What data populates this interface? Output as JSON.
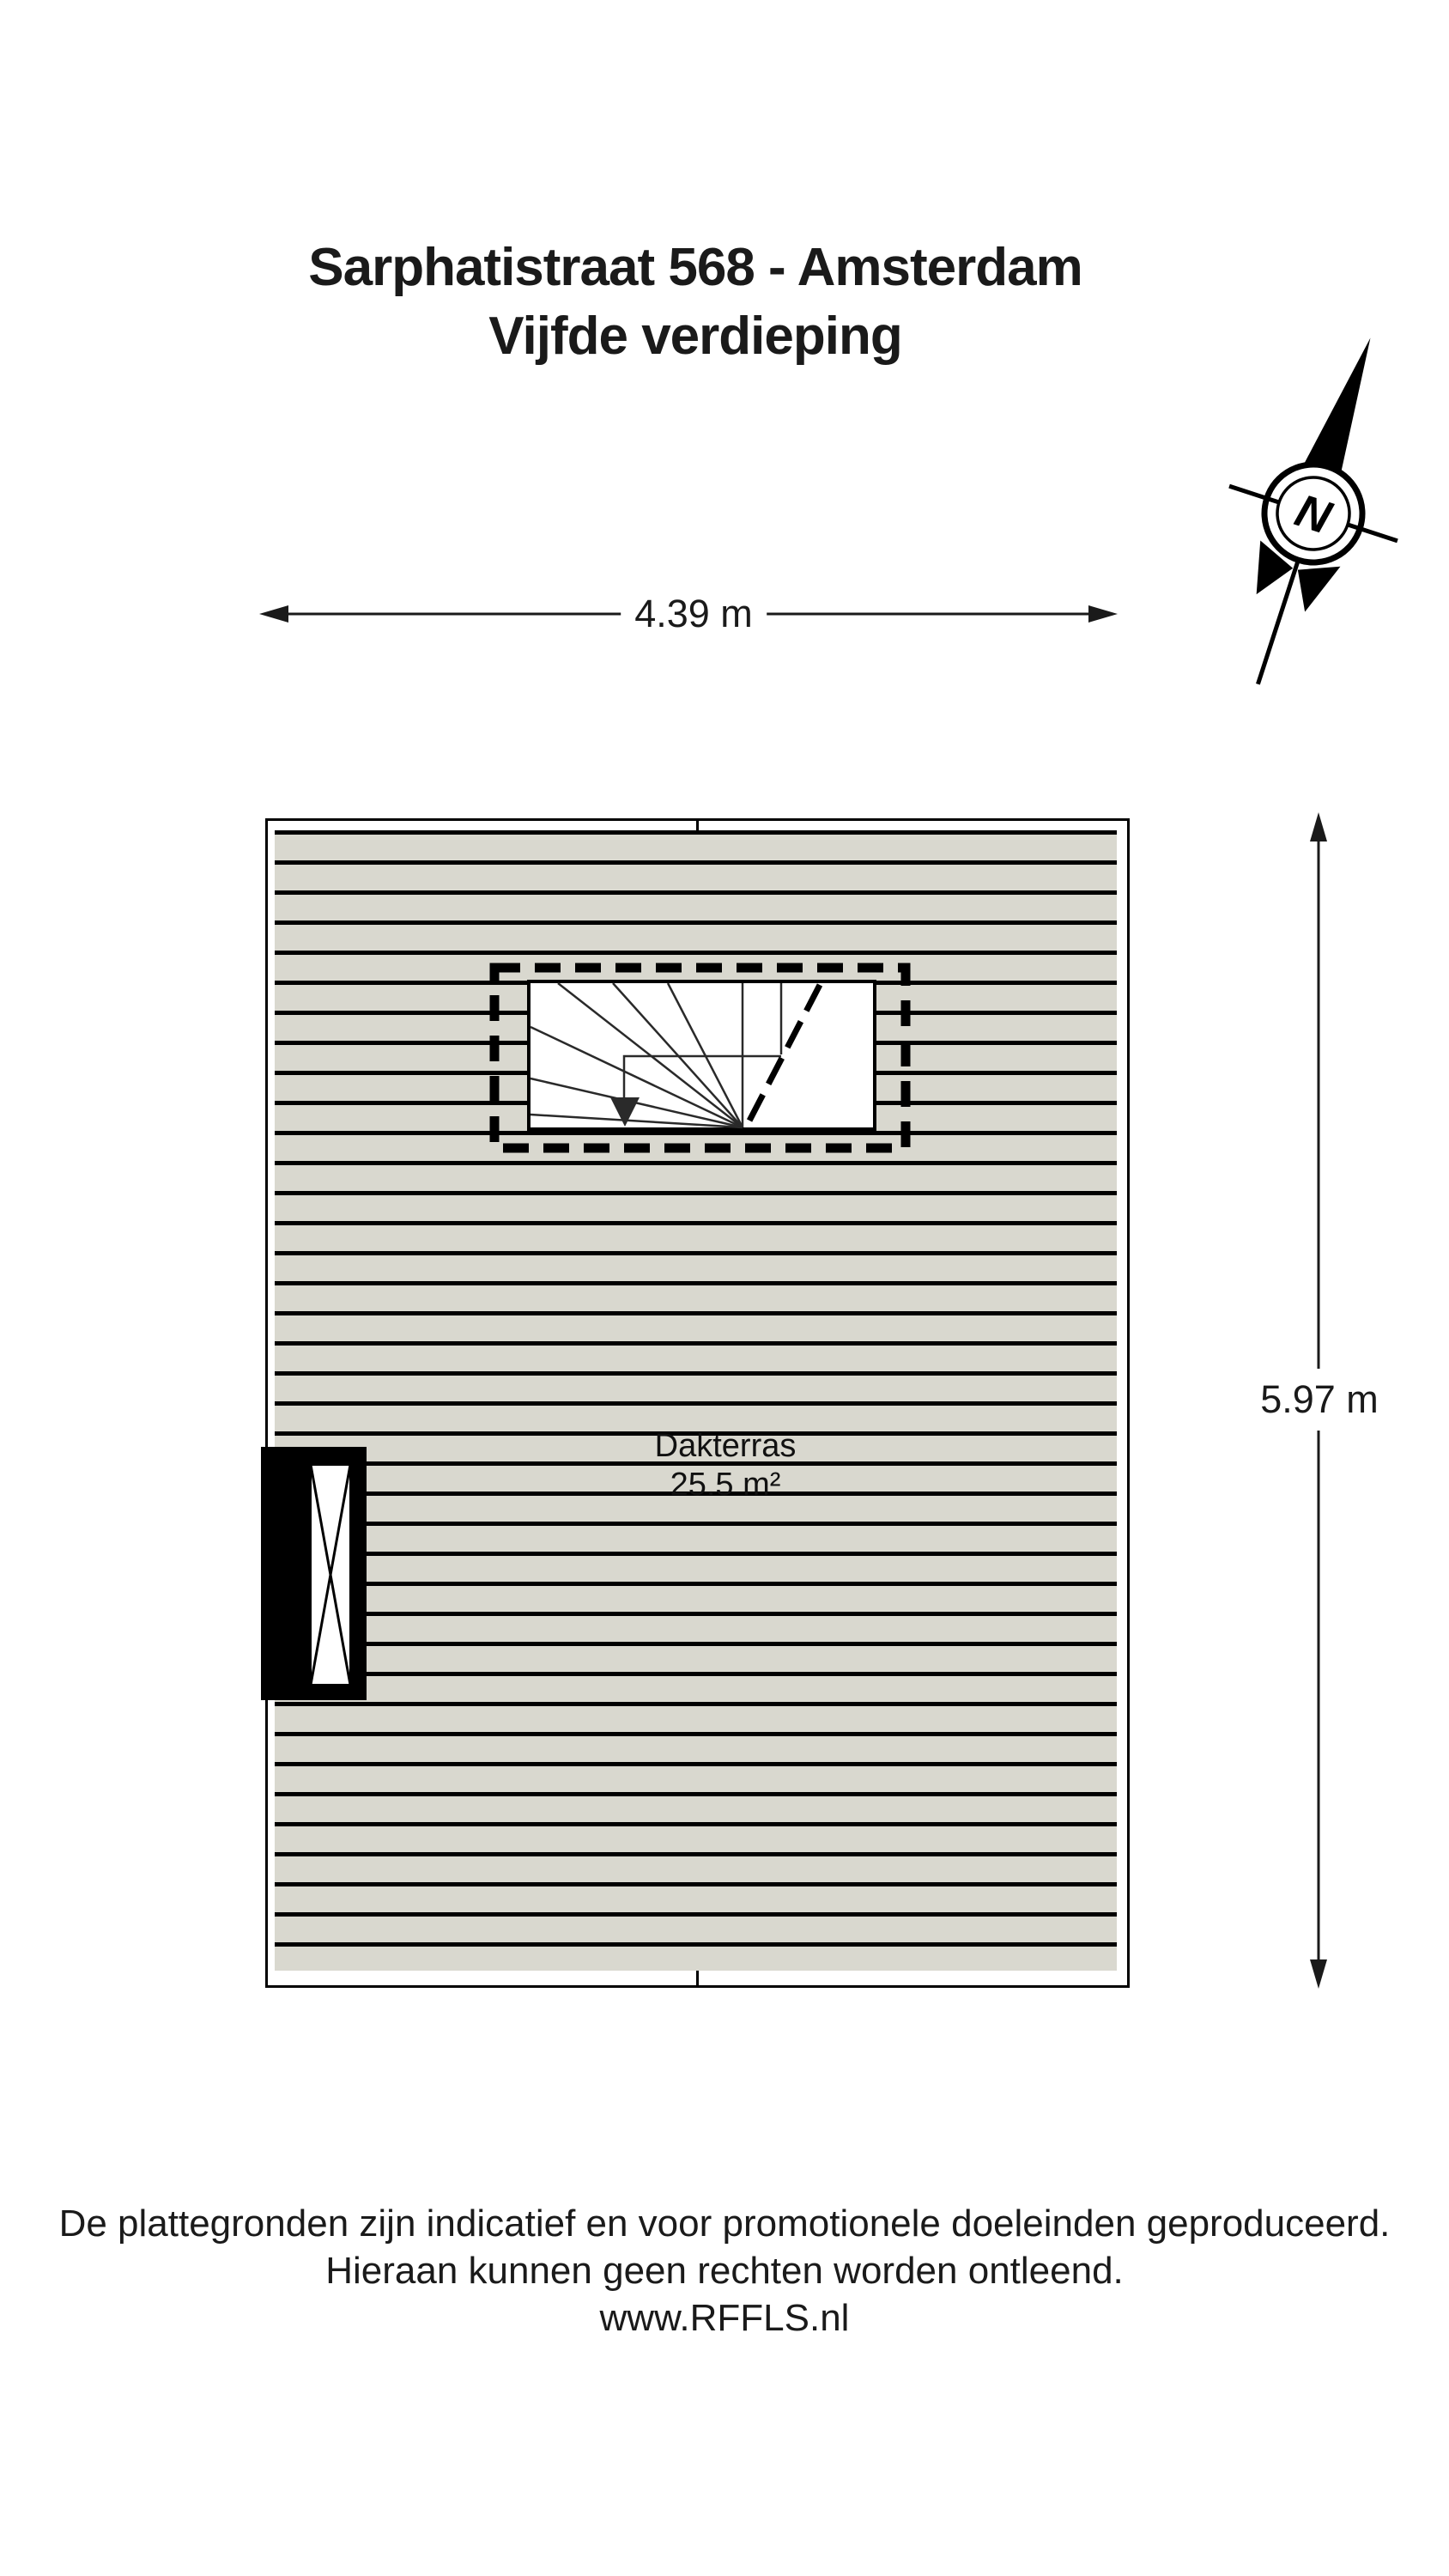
{
  "header": {
    "title_line1": "Sarphatistraat 568 - Amsterdam",
    "title_line2": "Vijfde verdieping"
  },
  "compass": {
    "north_label": "N"
  },
  "dimensions": {
    "width_label": "4.39 m",
    "height_label": "5.97 m"
  },
  "floor_plan": {
    "room_name": "Dakterras",
    "room_area": "25.5 m²"
  },
  "footer": {
    "line1": "De plattegronden zijn indicatief en voor promotionele doeleinden geproduceerd.",
    "line2": "Hieraan kunnen geen rechten worden ontleend.",
    "line3": "www.RFFLS.nl"
  },
  "colors": {
    "ink": "#1a1a1a",
    "deck_board": "#d9d8cf",
    "board_line": "#000000",
    "stair_fill": "#ffffff"
  }
}
